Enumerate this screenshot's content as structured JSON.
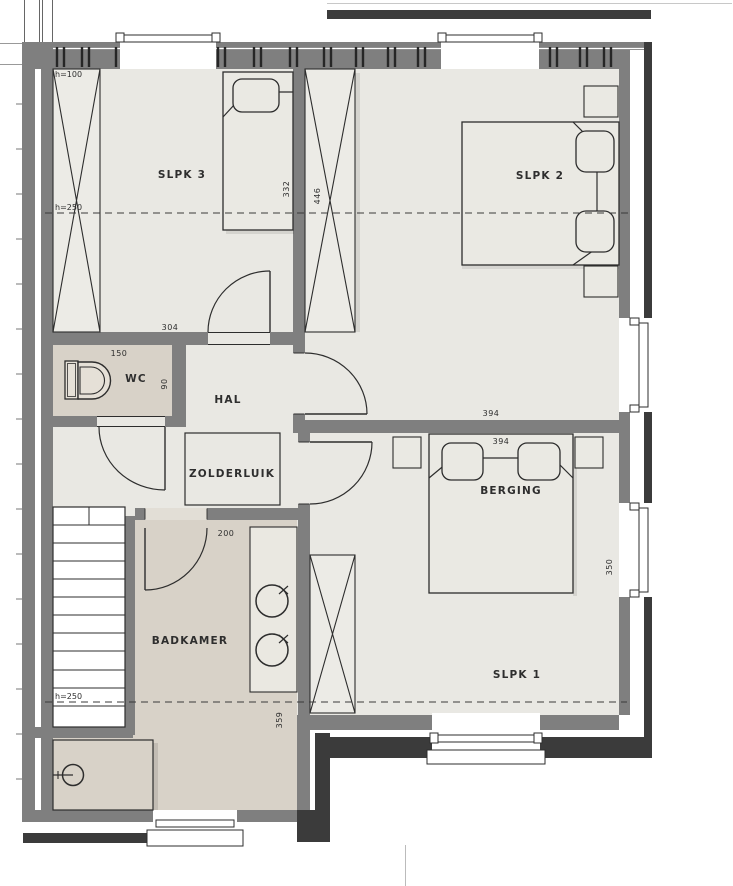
{
  "colors": {
    "floor": "#e9e8e3",
    "wet_floor": "#d8d2c8",
    "wall": "#7f7f7f",
    "wall_dark": "#3b3b3b",
    "line": "#2d2d2d"
  },
  "rooms": {
    "slpk3": "SLPK 3",
    "slpk2": "SLPK 2",
    "slpk1": "SLPK 1",
    "wc": "WC",
    "hal": "HAL",
    "zolderluik": "ZOLDERLUIK",
    "berging": "BERGING",
    "badkamer": "BADKAMER"
  },
  "dims": {
    "d304": "304",
    "d332": "332",
    "d446": "446",
    "d150": "150",
    "d90": "90",
    "d200": "200",
    "d394_top": "394",
    "d394_bed": "394",
    "d350": "350",
    "d359": "359"
  },
  "heights": {
    "h100": "h=100",
    "h250_upper": "h=250",
    "h250_lower": "h=250"
  }
}
